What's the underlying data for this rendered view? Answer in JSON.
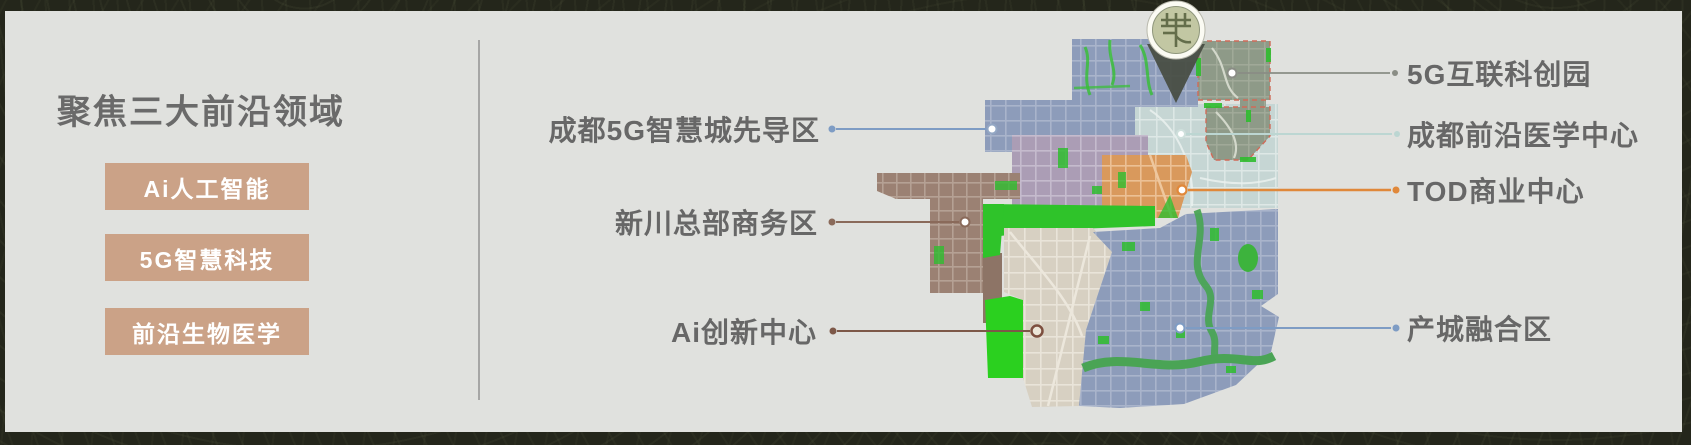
{
  "left_section": {
    "title": "聚焦三大前沿领域",
    "title_color": "#6a6a6a",
    "item_bg": "#cba287",
    "items": [
      {
        "label": "Ai人工智能"
      },
      {
        "label": "5G智慧科技"
      },
      {
        "label": "前沿生物医学"
      }
    ]
  },
  "map": {
    "pin_icon": "location-pin-with-round-emblem",
    "callouts_left": [
      {
        "label": "成都5G智慧城先导区",
        "line_color": "#7e9cc4"
      },
      {
        "label": "新川总部商务区",
        "line_color": "#8a6a5a"
      },
      {
        "label": "Ai创新中心",
        "line_color": "#7d5848"
      }
    ],
    "callouts_right": [
      {
        "label": "5G互联科创园",
        "line_color": "#8a8d85"
      },
      {
        "label": "成都前沿医学中心",
        "line_color": "#bcd6d2"
      },
      {
        "label": "TOD商业中心",
        "line_color": "#e0883a"
      },
      {
        "label": "产城融合区",
        "line_color": "#7e9cc4"
      }
    ],
    "zone_colors": {
      "pilot_zone_blue": "#8d9cba",
      "tech_park_olive": "#8e9a88",
      "medical_center_teal": "#c6d6d4",
      "tod_orange": "#d9995c",
      "headquarters_brown": "#9b8173",
      "innovation_beige": "#d7d0c2",
      "mixed_purple": "#ab9db5",
      "park_green": "#2fc32a"
    }
  },
  "frame": {
    "background": "#24261b"
  },
  "panel": {
    "background": "#e0e1de"
  }
}
